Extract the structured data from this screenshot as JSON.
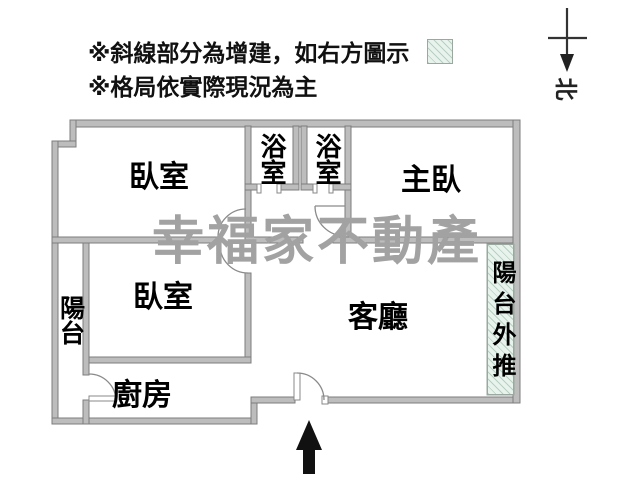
{
  "header": {
    "note1": "※斜線部分為增建，如右方圖示",
    "note2": "※格局依實際現況為主"
  },
  "legend": {
    "hatch_meaning": "增建 (addition), shown as hatched area"
  },
  "compass": {
    "north_label": "北"
  },
  "watermark": {
    "text": "幸福家不動產"
  },
  "rooms": {
    "bedroom1": "臥室",
    "bathroom1": "浴室",
    "bathroom2": "浴室",
    "master_bedroom": "主臥",
    "balcony": "陽台",
    "bedroom2": "臥室",
    "kitchen": "廚房",
    "living_room": "客廳",
    "balcony_extension": "陽台外推"
  },
  "colors": {
    "wall_fill": "#bdbdbd",
    "wall_edge": "#7d7d7d",
    "hatch_background": "#e7f3ec",
    "hatch_line": "#b8cfc2",
    "watermark": "#a2a2a2",
    "text": "#111111"
  }
}
